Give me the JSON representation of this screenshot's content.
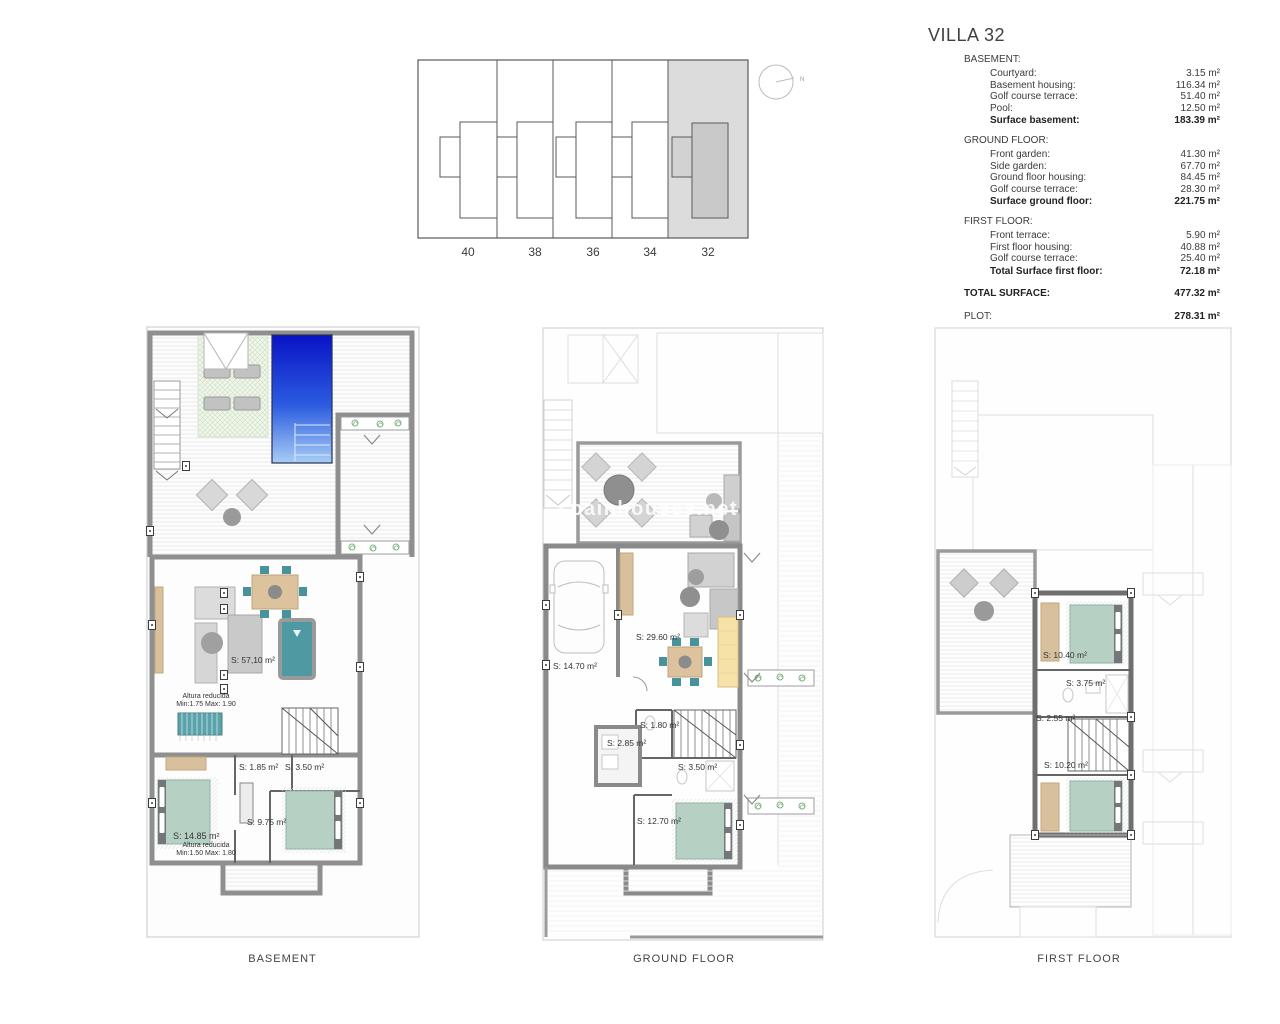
{
  "title": "VILLA 32",
  "site_plan": {
    "plot_numbers": [
      "40",
      "38",
      "36",
      "34",
      "32"
    ],
    "highlighted_plot": "32",
    "compass_label": "N"
  },
  "summary": {
    "sections": [
      {
        "header": "BASEMENT:",
        "rows": [
          {
            "label": "Courtyard:",
            "value": "3.15 m²"
          },
          {
            "label": "Basement housing:",
            "value": "116.34 m²"
          },
          {
            "label": "Golf course terrace:",
            "value": "51.40 m²"
          },
          {
            "label": "Pool:",
            "value": "12.50 m²"
          }
        ],
        "total": {
          "label": "Surface basement:",
          "value": "183.39 m²"
        }
      },
      {
        "header": "GROUND FLOOR:",
        "rows": [
          {
            "label": "Front garden:",
            "value": "41.30 m²"
          },
          {
            "label": "Side garden:",
            "value": "67.70 m²"
          },
          {
            "label": "Ground floor housing:",
            "value": "84.45 m²"
          },
          {
            "label": "Golf course terrace:",
            "value": "28.30 m²"
          }
        ],
        "total": {
          "label": "Surface ground floor:",
          "value": "221.75 m²"
        }
      },
      {
        "header": "FIRST FLOOR:",
        "rows": [
          {
            "label": "Front terrace:",
            "value": "5.90 m²"
          },
          {
            "label": "First floor housing:",
            "value": "40.88 m²"
          },
          {
            "label": "Golf course terrace:",
            "value": "25.40 m²"
          }
        ],
        "total": {
          "label": "Total Surface first floor:",
          "value": "72.18 m²"
        }
      }
    ],
    "grand_totals": [
      {
        "label": "TOTAL SURFACE:",
        "value": "477.32 m²"
      },
      {
        "label": "PLOT:",
        "value": "278.31 m²"
      }
    ]
  },
  "plans": {
    "basement": {
      "name": "BASEMENT",
      "labels": {
        "living": "S: 57,10 m²",
        "altura_1_line1": "Altura reducida",
        "altura_1_line2": "Min:1.75 Max: 1.90",
        "toilet": "S: 1.85 m²",
        "bathroom": "S: 3.50 m²",
        "hallway": "S: 9.75 m²",
        "bedroom": "S: 14.85 m²",
        "altura_2_line1": "Altura reducida",
        "altura_2_line2": "Min:1.50 Max: 1.80"
      }
    },
    "ground": {
      "name": "GROUND FLOOR",
      "labels": {
        "garage": "S: 14.70 m²",
        "living": "S: 29.60 m²",
        "toilet": "S: 1.80 m²",
        "storage": "S: 2.85 m²",
        "bathroom": "S: 3.50 m²",
        "bedroom": "S: 12.70 m²"
      }
    },
    "first": {
      "name": "FIRST FLOOR",
      "labels": {
        "bedroom_1": "S: 10.40 m²",
        "bathroom": "S: 3.75 m²",
        "hallway": "S: 2.55 m²",
        "bedroom_2": "S: 10.20 m²"
      }
    }
  },
  "watermark": "spainhouses.net",
  "colors": {
    "pool_top": "#0813c6",
    "pool_bottom": "#a8cdf5",
    "bed": "#b6d1c3",
    "pool_table": "#4e99a2",
    "dining_table": "#dcc39e",
    "kitchen": "#f6e2a8",
    "plot_highlight": "#dcdcdc",
    "planter_green": "#7fb37f"
  }
}
